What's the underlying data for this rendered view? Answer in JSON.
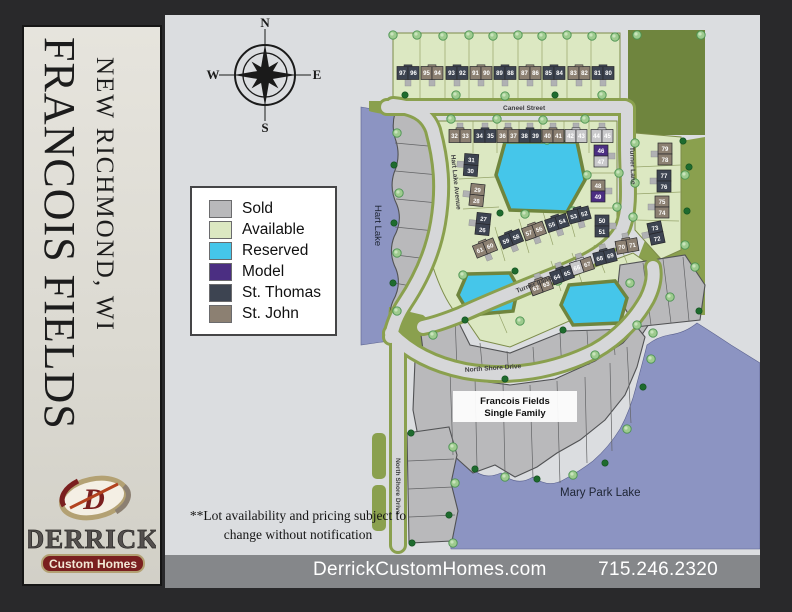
{
  "panel": {
    "title": "FRANCOIS FIELDS",
    "subtitle": "NEW RICHMOND, WI"
  },
  "logo": {
    "monogram": "D",
    "name": "DERRICK",
    "tagline": "Custom Homes",
    "accent": "#7a1f1f",
    "gold": "#b3a173"
  },
  "footer": {
    "website": "DerrickCustomHomes.com",
    "phone": "715.246.2320"
  },
  "disclaimer": {
    "line1": "**Lot availability and pricing subject to",
    "line2": "change without notification"
  },
  "compass": {
    "n": "N",
    "e": "E",
    "s": "S",
    "w": "W"
  },
  "legend": {
    "items": [
      {
        "label": "Sold",
        "color": "#b9b9bb"
      },
      {
        "label": "Available",
        "color": "#dce8c2"
      },
      {
        "label": "Reserved",
        "color": "#45c6ea"
      },
      {
        "label": "Model",
        "color": "#4b2e82"
      },
      {
        "label": "St. Thomas",
        "color": "#3d4451"
      },
      {
        "label": "St. John",
        "color": "#8c8072"
      }
    ]
  },
  "map": {
    "house_colors": {
      "T": "#3d4451",
      "J": "#8c8072",
      "S": "#c9c9cb",
      "M": "#4b2e82"
    },
    "callout": {
      "line1": "Francois Fields",
      "line2": "Single Family"
    },
    "labels": [
      {
        "text": "Caneel Street",
        "x": 338,
        "y": 95,
        "rot": 0,
        "cls": "street-label"
      },
      {
        "text": "Hart Lake Avenue",
        "x": 286,
        "y": 140,
        "rot": 84,
        "cls": "street-label"
      },
      {
        "text": "Turner Lane",
        "x": 465,
        "y": 132,
        "rot": 88,
        "cls": "street-label"
      },
      {
        "text": "Turner Lane",
        "x": 352,
        "y": 278,
        "rot": -21,
        "cls": "street-label"
      },
      {
        "text": "North Shore Drive",
        "x": 300,
        "y": 357,
        "rot": -4,
        "cls": "street-label"
      },
      {
        "text": "North Shore Drive",
        "x": 231,
        "y": 443,
        "rot": 90,
        "cls": "street-label"
      },
      {
        "text": "Hart Lake",
        "x": 210,
        "y": 190,
        "rot": 90,
        "cls": "water-label"
      },
      {
        "text": "Mary Park Lake",
        "x": 395,
        "y": 481,
        "rot": 0,
        "cls": "water-label-lg"
      }
    ],
    "houses": [
      {
        "n": [
          "97",
          "96"
        ],
        "x": 243,
        "y": 58,
        "rot": 0,
        "dir": "h",
        "drv": "s",
        "c": [
          "T",
          "T"
        ]
      },
      {
        "n": [
          "95",
          "94"
        ],
        "x": 267,
        "y": 58,
        "rot": 0,
        "dir": "h",
        "drv": "s",
        "c": [
          "J",
          "J"
        ]
      },
      {
        "n": [
          "93",
          "92"
        ],
        "x": 292,
        "y": 58,
        "rot": 0,
        "dir": "h",
        "drv": "s",
        "c": [
          "T",
          "T"
        ]
      },
      {
        "n": [
          "91",
          "90"
        ],
        "x": 316,
        "y": 58,
        "rot": 0,
        "dir": "h",
        "drv": "s",
        "c": [
          "J",
          "J"
        ]
      },
      {
        "n": [
          "89",
          "88"
        ],
        "x": 340,
        "y": 58,
        "rot": 0,
        "dir": "h",
        "drv": "s",
        "c": [
          "T",
          "T"
        ]
      },
      {
        "n": [
          "87",
          "86"
        ],
        "x": 365,
        "y": 58,
        "rot": 0,
        "dir": "h",
        "drv": "s",
        "c": [
          "J",
          "J"
        ]
      },
      {
        "n": [
          "85",
          "84"
        ],
        "x": 389,
        "y": 58,
        "rot": 0,
        "dir": "h",
        "drv": "s",
        "c": [
          "T",
          "T"
        ]
      },
      {
        "n": [
          "83",
          "82"
        ],
        "x": 414,
        "y": 58,
        "rot": 0,
        "dir": "h",
        "drv": "s",
        "c": [
          "J",
          "J"
        ]
      },
      {
        "n": [
          "81",
          "80"
        ],
        "x": 438,
        "y": 58,
        "rot": 0,
        "dir": "h",
        "drv": "s",
        "c": [
          "T",
          "T"
        ]
      },
      {
        "n": [
          "32",
          "33"
        ],
        "x": 295,
        "y": 121,
        "rot": 0,
        "dir": "h",
        "drv": "n",
        "c": [
          "J",
          "J"
        ]
      },
      {
        "n": [
          "34",
          "35"
        ],
        "x": 320,
        "y": 121,
        "rot": 0,
        "dir": "h",
        "drv": "n",
        "c": [
          "T",
          "T"
        ]
      },
      {
        "n": [
          "36",
          "37"
        ],
        "x": 343,
        "y": 121,
        "rot": 0,
        "dir": "h",
        "drv": "n",
        "c": [
          "J",
          "J"
        ]
      },
      {
        "n": [
          "38",
          "39"
        ],
        "x": 365,
        "y": 121,
        "rot": 0,
        "dir": "h",
        "drv": "n",
        "c": [
          "T",
          "T"
        ]
      },
      {
        "n": [
          "40",
          "41"
        ],
        "x": 388,
        "y": 121,
        "rot": 0,
        "dir": "h",
        "drv": "n",
        "c": [
          "J",
          "J"
        ]
      },
      {
        "n": [
          "42",
          "43"
        ],
        "x": 411,
        "y": 121,
        "rot": 0,
        "dir": "h",
        "drv": "n",
        "c": [
          "S",
          "S"
        ]
      },
      {
        "n": [
          "44",
          "45"
        ],
        "x": 437,
        "y": 121,
        "rot": 0,
        "dir": "h",
        "drv": "n",
        "c": [
          "S",
          "S"
        ]
      },
      {
        "n": [
          "31",
          "30"
        ],
        "x": 306,
        "y": 150,
        "rot": 4,
        "dir": "v",
        "drv": "w",
        "c": [
          "T",
          "T"
        ]
      },
      {
        "n": [
          "29",
          "28"
        ],
        "x": 312,
        "y": 180,
        "rot": 6,
        "dir": "v",
        "drv": "w",
        "c": [
          "J",
          "J"
        ]
      },
      {
        "n": [
          "27",
          "26"
        ],
        "x": 318,
        "y": 209,
        "rot": 6,
        "dir": "v",
        "drv": "w",
        "c": [
          "T",
          "T"
        ]
      },
      {
        "n": [
          "61",
          "60"
        ],
        "x": 320,
        "y": 233,
        "rot": -22,
        "dir": "h",
        "drv": "s",
        "c": [
          "J",
          "J"
        ]
      },
      {
        "n": [
          "59",
          "58"
        ],
        "x": 346,
        "y": 224,
        "rot": -22,
        "dir": "h",
        "drv": "s",
        "c": [
          "T",
          "T"
        ]
      },
      {
        "n": [
          "57",
          "56"
        ],
        "x": 369,
        "y": 216,
        "rot": -20,
        "dir": "h",
        "drv": "s",
        "c": [
          "J",
          "J"
        ]
      },
      {
        "n": [
          "55",
          "54"
        ],
        "x": 392,
        "y": 208,
        "rot": -18,
        "dir": "h",
        "drv": "s",
        "c": [
          "T",
          "T"
        ]
      },
      {
        "n": [
          "53",
          "52"
        ],
        "x": 414,
        "y": 200,
        "rot": -15,
        "dir": "h",
        "drv": "s",
        "c": [
          "T",
          "T"
        ]
      },
      {
        "n": [
          "46",
          "47"
        ],
        "x": 436,
        "y": 141,
        "rot": 0,
        "dir": "v",
        "drv": "e",
        "c": [
          "M",
          "S"
        ]
      },
      {
        "n": [
          "48",
          "49"
        ],
        "x": 433,
        "y": 176,
        "rot": 0,
        "dir": "v",
        "drv": "e",
        "c": [
          "J",
          "M"
        ]
      },
      {
        "n": [
          "50",
          "51"
        ],
        "x": 437,
        "y": 211,
        "rot": 0,
        "dir": "v",
        "drv": "e",
        "c": [
          "T",
          "T"
        ]
      },
      {
        "n": [
          "62",
          "63"
        ],
        "x": 376,
        "y": 271,
        "rot": -20,
        "dir": "h",
        "drv": "n",
        "c": [
          "J",
          "J"
        ]
      },
      {
        "n": [
          "64",
          "65"
        ],
        "x": 397,
        "y": 260,
        "rot": -20,
        "dir": "h",
        "drv": "n",
        "c": [
          "T",
          "T"
        ]
      },
      {
        "n": [
          "66",
          "67"
        ],
        "x": 417,
        "y": 251,
        "rot": -18,
        "dir": "h",
        "drv": "n",
        "c": [
          "S",
          "J"
        ]
      },
      {
        "n": [
          "68",
          "69"
        ],
        "x": 440,
        "y": 242,
        "rot": -14,
        "dir": "h",
        "drv": "n",
        "c": [
          "T",
          "T"
        ]
      },
      {
        "n": [
          "70",
          "71"
        ],
        "x": 462,
        "y": 231,
        "rot": -10,
        "dir": "h",
        "drv": "n",
        "c": [
          "J",
          "J"
        ]
      },
      {
        "n": [
          "79",
          "78"
        ],
        "x": 500,
        "y": 139,
        "rot": 0,
        "dir": "v",
        "drv": "w",
        "c": [
          "J",
          "J"
        ]
      },
      {
        "n": [
          "77",
          "76"
        ],
        "x": 499,
        "y": 166,
        "rot": 0,
        "dir": "v",
        "drv": "w",
        "c": [
          "T",
          "T"
        ]
      },
      {
        "n": [
          "75",
          "74"
        ],
        "x": 497,
        "y": 192,
        "rot": 0,
        "dir": "v",
        "drv": "w",
        "c": [
          "J",
          "J"
        ]
      },
      {
        "n": [
          "73",
          "72"
        ],
        "x": 491,
        "y": 218,
        "rot": -12,
        "dir": "v",
        "drv": "w",
        "c": [
          "T",
          "T"
        ]
      }
    ],
    "trees": [
      [
        228,
        20,
        "l"
      ],
      [
        252,
        20,
        "l"
      ],
      [
        278,
        21,
        "l"
      ],
      [
        304,
        20,
        "l"
      ],
      [
        328,
        21,
        "l"
      ],
      [
        353,
        20,
        "l"
      ],
      [
        377,
        21,
        "l"
      ],
      [
        402,
        20,
        "l"
      ],
      [
        427,
        21,
        "l"
      ],
      [
        450,
        22,
        "l"
      ],
      [
        240,
        80,
        "d"
      ],
      [
        291,
        80,
        "l"
      ],
      [
        340,
        81,
        "l"
      ],
      [
        390,
        80,
        "d"
      ],
      [
        437,
        80,
        "l"
      ],
      [
        286,
        104,
        "l"
      ],
      [
        332,
        104,
        "l"
      ],
      [
        378,
        105,
        "l"
      ],
      [
        420,
        104,
        "l"
      ],
      [
        340,
        124,
        "l"
      ],
      [
        382,
        125,
        "l"
      ],
      [
        335,
        198,
        "d"
      ],
      [
        360,
        199,
        "l"
      ],
      [
        408,
        196,
        "l"
      ],
      [
        422,
        160,
        "l"
      ],
      [
        232,
        118,
        "l"
      ],
      [
        229,
        150,
        "d"
      ],
      [
        234,
        178,
        "l"
      ],
      [
        229,
        208,
        "d"
      ],
      [
        232,
        238,
        "l"
      ],
      [
        228,
        268,
        "d"
      ],
      [
        232,
        296,
        "l"
      ],
      [
        472,
        20,
        "l"
      ],
      [
        536,
        20,
        "l"
      ],
      [
        470,
        128,
        "l"
      ],
      [
        518,
        126,
        "d"
      ],
      [
        520,
        160,
        "l"
      ],
      [
        470,
        168,
        "l"
      ],
      [
        522,
        196,
        "d"
      ],
      [
        468,
        202,
        "l"
      ],
      [
        520,
        230,
        "l"
      ],
      [
        454,
        158,
        "l"
      ],
      [
        452,
        192,
        "l"
      ],
      [
        298,
        260,
        "l"
      ],
      [
        350,
        256,
        "d"
      ],
      [
        393,
        266,
        "l"
      ],
      [
        300,
        305,
        "d"
      ],
      [
        355,
        306,
        "l"
      ],
      [
        398,
        315,
        "d"
      ],
      [
        465,
        268,
        "l"
      ],
      [
        488,
        318,
        "l"
      ],
      [
        268,
        320,
        "l"
      ],
      [
        340,
        364,
        "d"
      ],
      [
        430,
        340,
        "l"
      ],
      [
        472,
        310,
        "l"
      ],
      [
        505,
        282,
        "l"
      ],
      [
        310,
        454,
        "d"
      ],
      [
        340,
        462,
        "l"
      ],
      [
        372,
        464,
        "d"
      ],
      [
        408,
        460,
        "l"
      ],
      [
        440,
        448,
        "d"
      ],
      [
        462,
        414,
        "l"
      ],
      [
        478,
        372,
        "d"
      ],
      [
        486,
        344,
        "l"
      ],
      [
        246,
        418,
        "d"
      ],
      [
        288,
        432,
        "l"
      ],
      [
        290,
        468,
        "l"
      ],
      [
        284,
        500,
        "d"
      ],
      [
        247,
        528,
        "d"
      ],
      [
        288,
        528,
        "l"
      ],
      [
        524,
        152,
        "d"
      ],
      [
        530,
        252,
        "l"
      ],
      [
        534,
        296,
        "d"
      ]
    ]
  }
}
